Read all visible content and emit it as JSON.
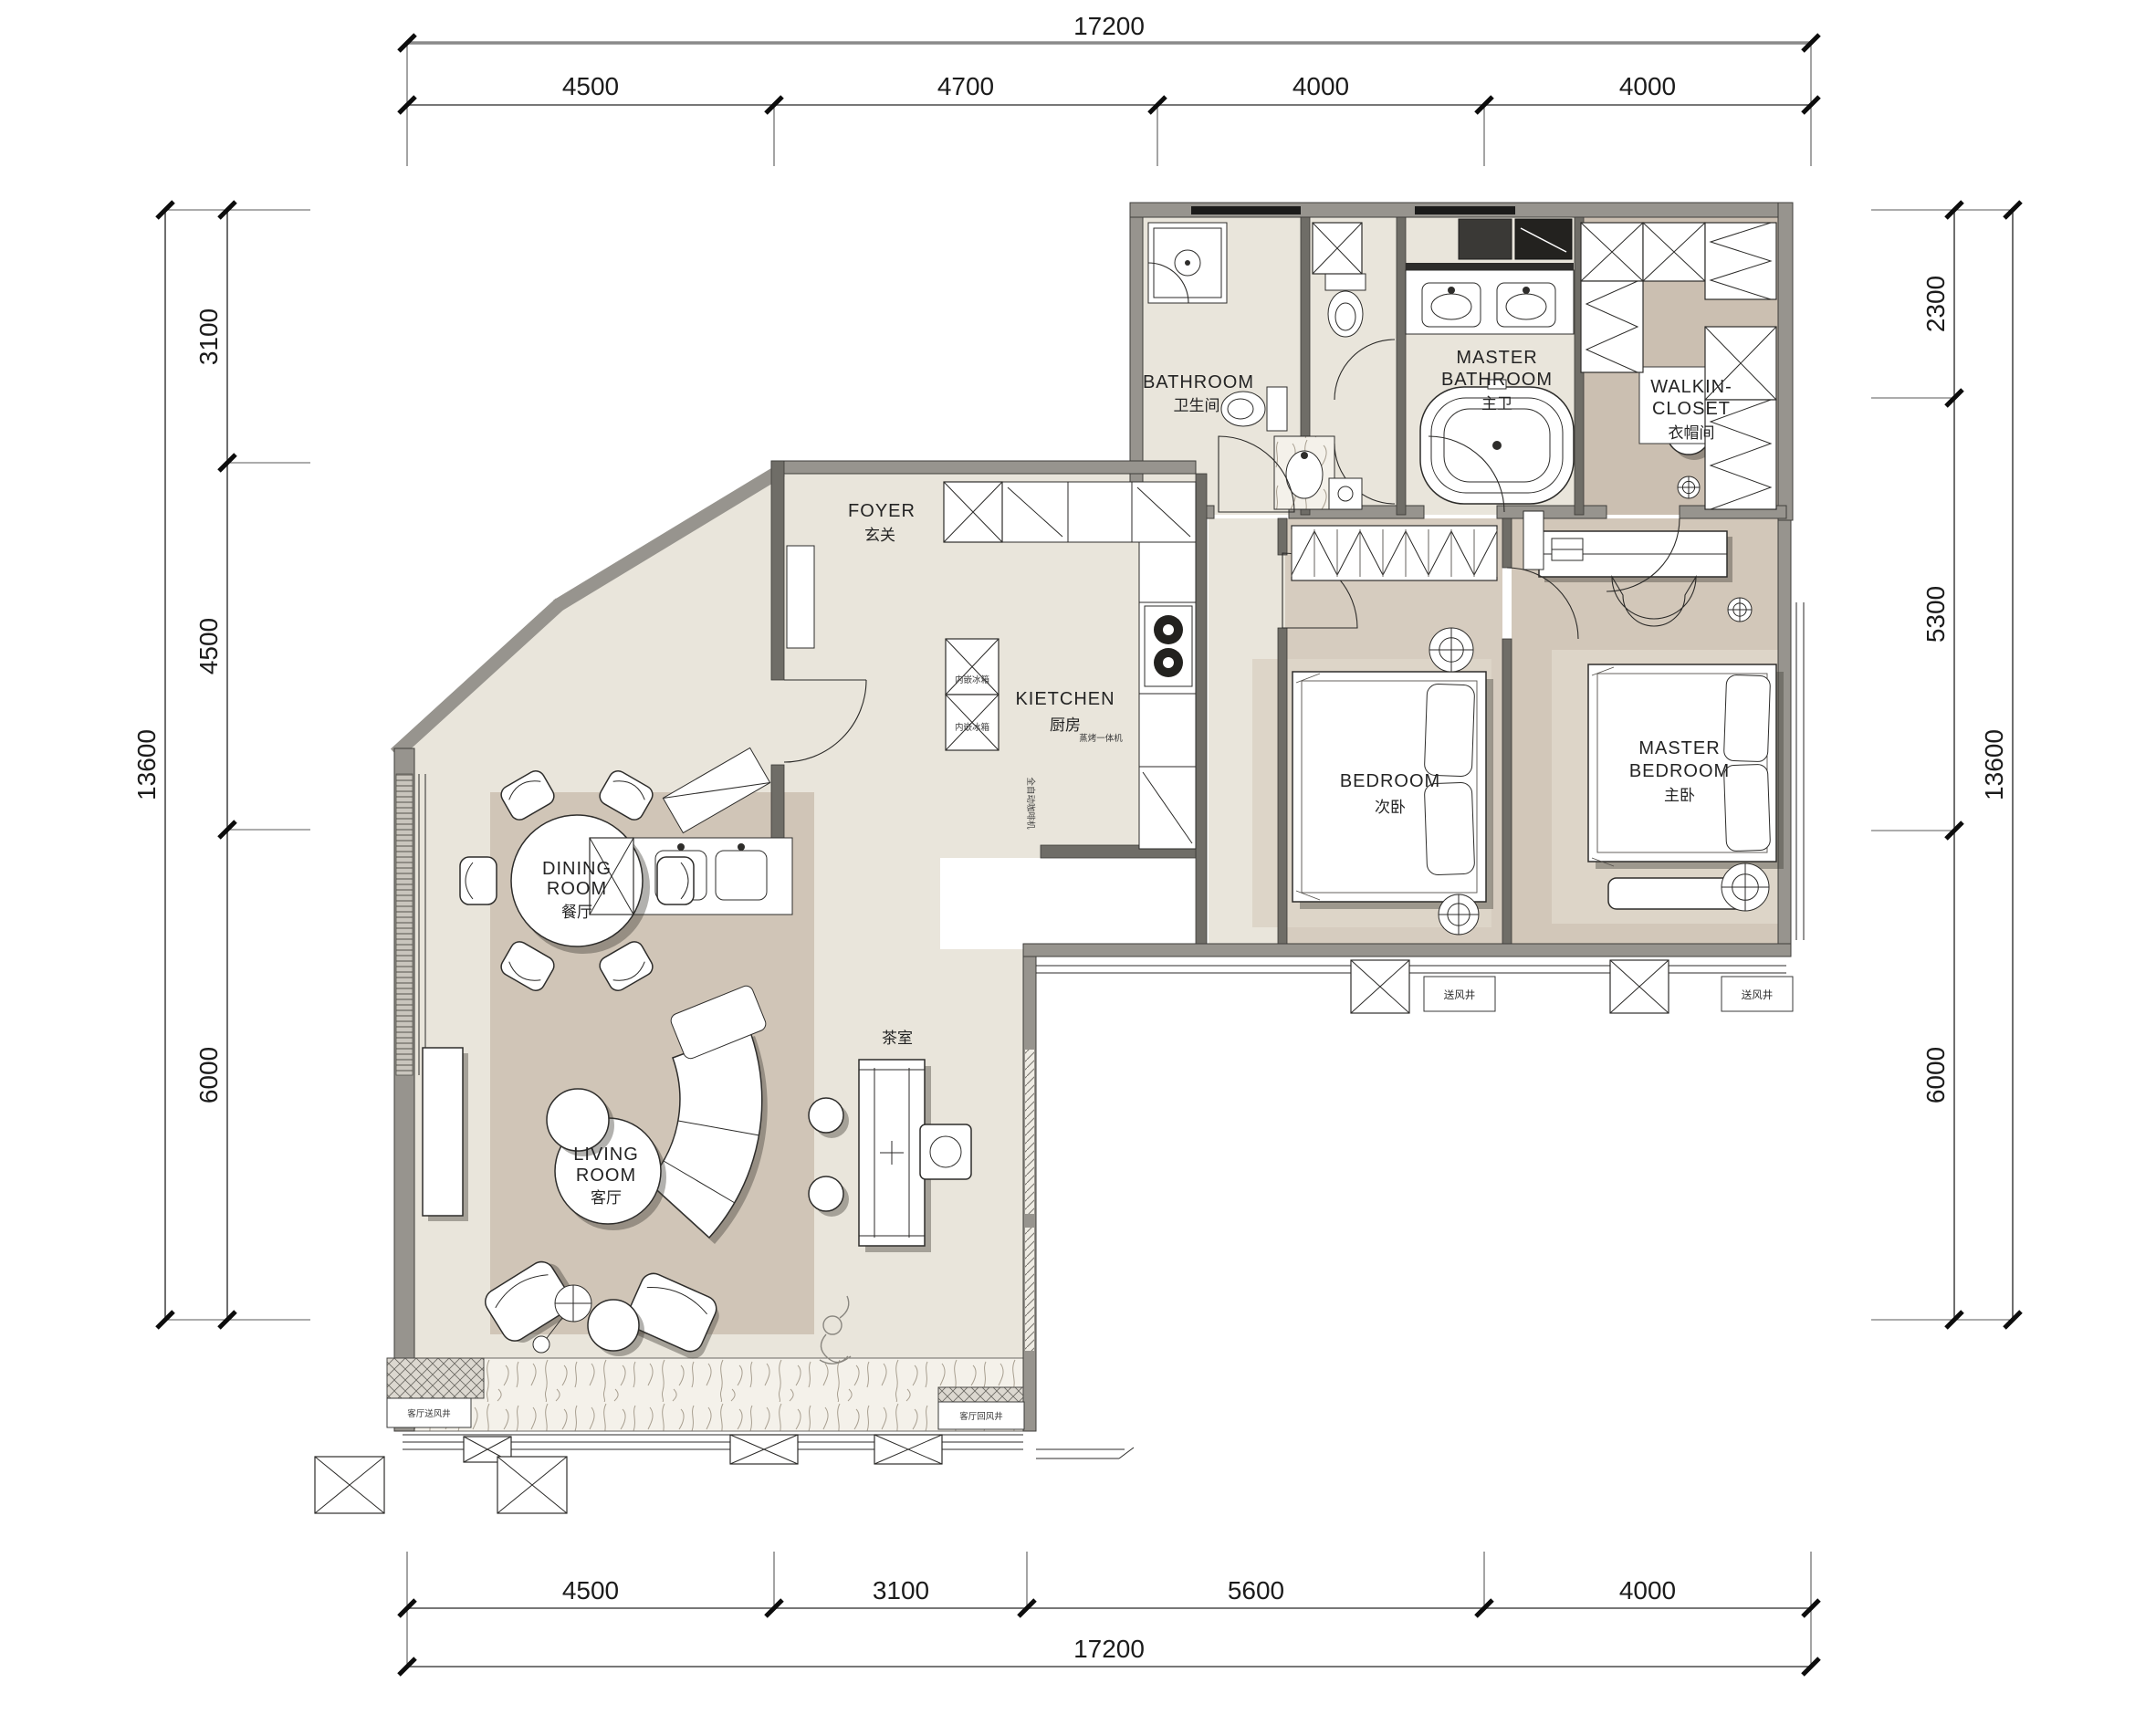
{
  "drawing": {
    "type": "residential floor plan",
    "dims_top": {
      "total": "17200",
      "segments": [
        "4500",
        "4700",
        "4000",
        "4000"
      ]
    },
    "dims_bottom": {
      "total": "17200",
      "segments": [
        "4500",
        "3100",
        "5600",
        "4000"
      ]
    },
    "dims_left": {
      "total": "13600",
      "segments": [
        "3100",
        "4500",
        "6000"
      ]
    },
    "dims_right": {
      "total": "13600",
      "segments": [
        "2300",
        "5300",
        "6000"
      ]
    },
    "rooms": {
      "bathroom": {
        "en": "BATHROOM",
        "cn": "卫生间"
      },
      "master_bathroom": {
        "en1": "MASTER",
        "en2": "BATHROOM",
        "cn": "主卫"
      },
      "walkin_closet": {
        "en1": "WALKIN-",
        "en2": "CLOSET",
        "cn": "衣帽间"
      },
      "foyer": {
        "en": "FOYER",
        "cn": "玄关"
      },
      "kitchen": {
        "en": "KIETCHEN",
        "cn": "厨房"
      },
      "bedroom": {
        "en": "BEDROOM",
        "cn": "次卧"
      },
      "master_bedroom": {
        "en1": "MASTER",
        "en2": "BEDROOM",
        "cn": "主卧"
      },
      "dining_room": {
        "en1": "DINING",
        "en2": "ROOM",
        "cn": "餐厅"
      },
      "living_room": {
        "en1": "LIVING",
        "en2": "ROOM",
        "cn": "客厅"
      },
      "tea_room": {
        "cn": "茶室"
      }
    },
    "annotations": {
      "fridge_upper": "内嵌冰箱",
      "fridge_lower": "内嵌冰箱",
      "steam_oven": "蒸烤一体机",
      "coffee_machine": "全自动咖啡机",
      "bedroom_air_shaft": "送风井",
      "master_air_shaft": "送风井",
      "living_supply_shaft": "客厅送风井",
      "living_return_shaft": "客厅回风井"
    },
    "colors": {
      "wall": "#97948e",
      "floor_light": "#e9e5db",
      "floor_taupe": "#d4c9bc",
      "floor_closet": "#cbbfb1",
      "marble": "#f4f1ea"
    }
  }
}
